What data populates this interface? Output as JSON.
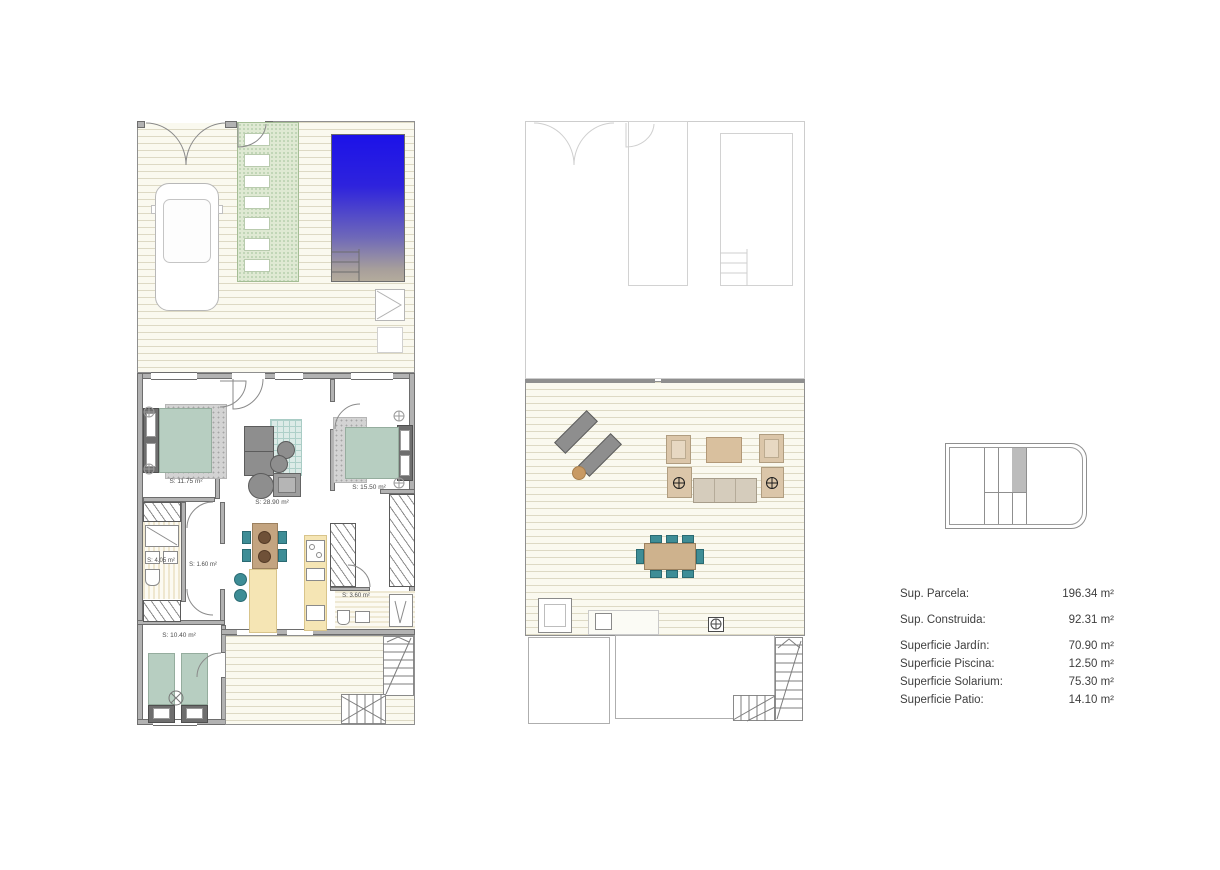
{
  "document": {
    "type": "architectural floor plan sheet",
    "language": "es"
  },
  "plans": {
    "ground_floor": {
      "name": "ground-floor-with-garden-and-pool",
      "rooms": {
        "bedroom_left": {
          "label": "S: 11.75 m²"
        },
        "living_kitchen": {
          "label": "S: 28.90 m²"
        },
        "bedroom_right": {
          "label": "S: 15.50 m²"
        },
        "bathroom_left": {
          "label": "S: 4.05 m²"
        },
        "hall": {
          "label": "S: 1.60 m²"
        },
        "bathroom_right": {
          "label": "S: 3.60 m²"
        },
        "bedroom_back": {
          "label": "S: 10.40 m²"
        }
      }
    },
    "solarium": {
      "name": "solarium-roof-terrace"
    }
  },
  "areas_table": {
    "rows": [
      {
        "label": "Sup. Parcela:",
        "value": "196.34 m²"
      },
      {
        "label": "Sup. Construida:",
        "value": "92.31 m²"
      },
      {
        "label": "Superficie Jardín:",
        "value": "70.90 m²"
      },
      {
        "label": "Superficie Piscina:",
        "value": "12.50 m²"
      },
      {
        "label": "Superficie Solarium:",
        "value": "75.30 m²"
      },
      {
        "label": "Superficie Patio:",
        "value": "14.10 m²"
      }
    ]
  },
  "colors": {
    "pool_top": "#1c12e8",
    "pool_bottom": "#b4ab9c",
    "path_green": "#dfe9d3",
    "bed_green": "#b7cec1",
    "chair_teal": "#3e8d96",
    "wood": "#c3a480",
    "counter_cream": "#f5e5b4",
    "furniture_gray": "#8e8e8e",
    "lounge_beige": "#dbc6a9",
    "wall_gray": "#b2b2b2",
    "deck_cream": "#faf9ef",
    "ghost_line": "#cdcdcd",
    "text": "#3e3e3e"
  }
}
